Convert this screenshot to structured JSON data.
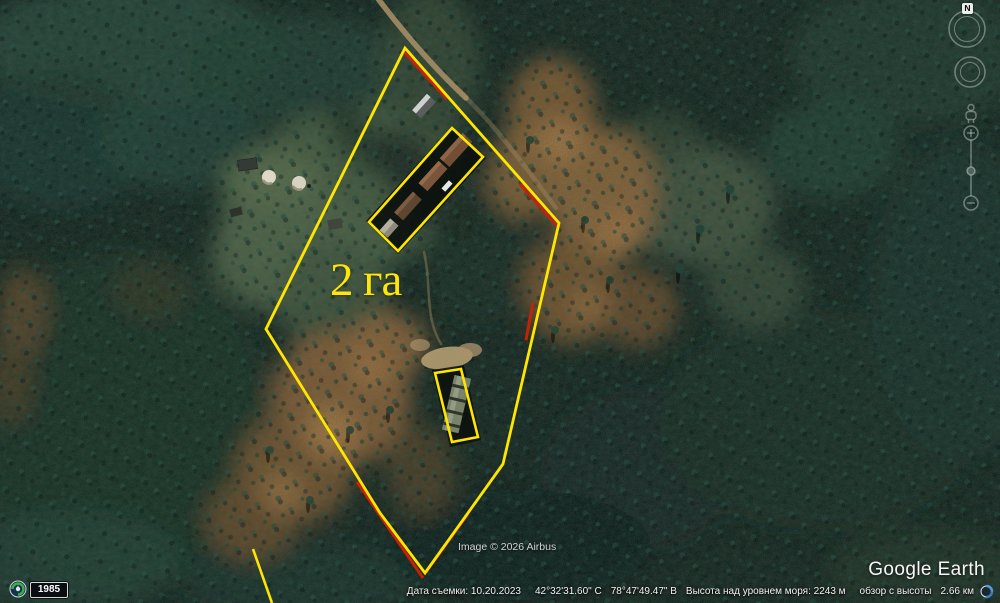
{
  "app": {
    "watermark": "Google Earth"
  },
  "map": {
    "area_label": "2 га",
    "attribution": "Image © 2026 Airbus",
    "annotation_colors": {
      "outline_yellow": "#ffe600",
      "outline_red_accent": "#c22208"
    }
  },
  "annotations": {
    "area_polygon_points": "405,48 559,223 503,464 425,573 380,513 266,329",
    "upper_building_outline_points": "452,128 483,157 398,251 369,222",
    "lower_building_outline_points": "435,373 461,369 478,437 452,442",
    "partial_edge_points": "253,549 272,603"
  },
  "status_bar": {
    "capture_date": "Дата съемки: 10.20.2023",
    "latitude": "42°32'31.60\" С",
    "longitude": "78°47'49.47\" В",
    "elevation": "Высота над уровнем моря:  2243 м",
    "eye_altitude_label": "обзор с высоты",
    "eye_altitude_value": "2.66 км"
  },
  "time_control": {
    "year": "1985"
  },
  "navigation": {
    "compass_label": "N",
    "zoom_in": "+",
    "zoom_out": "−"
  }
}
